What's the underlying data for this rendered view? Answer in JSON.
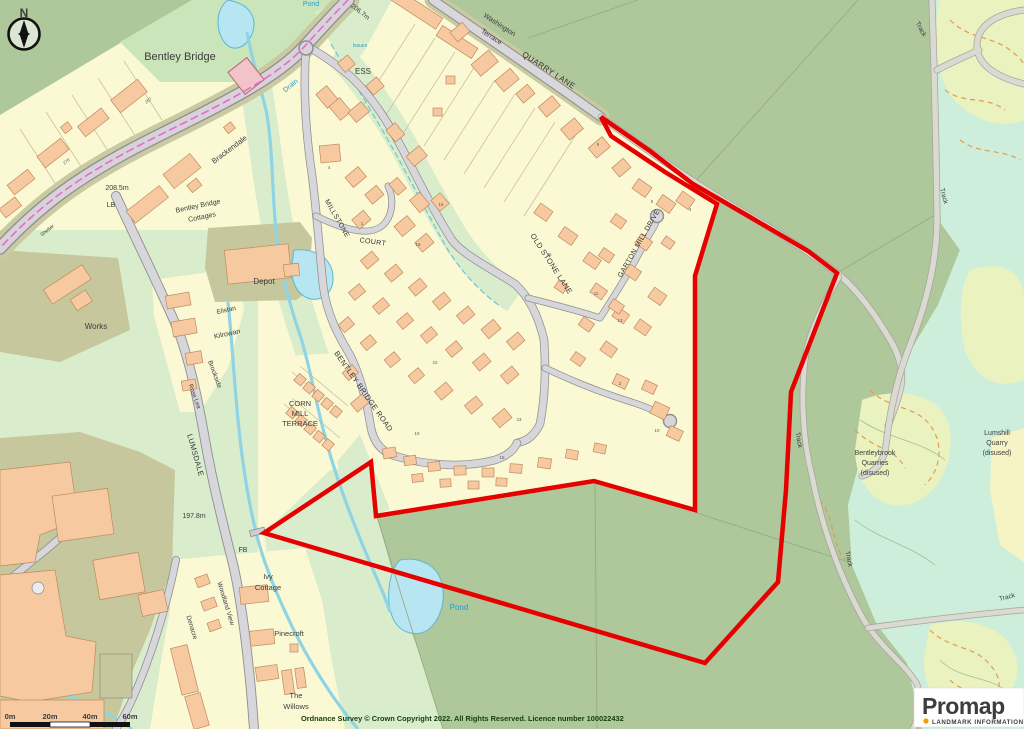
{
  "app": {
    "view": "promap-ordnance-survey-site-plan"
  },
  "logo": {
    "brand": "Promap",
    "tagline": "LANDMARK INFORMATION"
  },
  "compass": {
    "north": "N"
  },
  "scale_bar": {
    "m0": "0m",
    "m20": "20m",
    "m40": "40m",
    "m60": "60m"
  },
  "copyright": "Ordnance Survey © Crown Copyright 2022. All Rights Reserved. Licence number 100022432",
  "colors": {
    "boundary_red": "#e60000",
    "field_green": "#aec79b",
    "amenity_green": "#d9edcc",
    "quarry_mint": "#cdeeda",
    "residential_yellow": "#fbf9d4",
    "building_salmon": "#f6c9a0",
    "water_blue": "#b7e6f2",
    "road_grey": "#d7d7dc",
    "logo_orange": "#f59b00"
  },
  "labels": {
    "places": {
      "bentley_bridge": "Bentley Bridge",
      "brackendale": "Brackendale",
      "bentley_bridge_cottages_line1": "Bentley Bridge",
      "bentley_bridge_cottages_line2": "Cottages",
      "depot": "Depot",
      "works": "Works",
      "elistan": "Elistan",
      "kilrowan": "Kilrowan",
      "brookside": "Brookside",
      "rose_lea": "Rose Lea",
      "corn_mill_line1": "CORN",
      "corn_mill_line2": "MILL",
      "corn_mill_line3": "TERRACE",
      "ess": "ESS",
      "shelter": "Shelter",
      "ivy_cottage_line1": "Ivy",
      "ivy_cottage_line2": "Cottage",
      "pinecroft": "Pinecroft",
      "the_willows_line1": "The",
      "the_willows_line2": "Willows",
      "woodland_view": "Woodland View",
      "denacre": "Denacre",
      "washington_terrace_line1": "Washington",
      "washington_terrace_line2": "Terrace",
      "bentleybrook_line1": "Bentleybrook",
      "bentleybrook_line2": "Quarries",
      "bentleybrook_line3": "(disused)",
      "lumshill_line1": "Lumshill",
      "lumshill_line2": "Quarry",
      "lumshill_line3": "(disused)"
    },
    "roads": {
      "quarry_lane": "QUARRY LANE",
      "millstone_line1": "MILLSTONE",
      "millstone_line2": "COURT",
      "old_stone_lane": "OLD STONE LANE",
      "garton_mill_drive": "GARTON MILL DRIVE",
      "bentley_bridge_road": "BENTLEY BRIDGE ROAD",
      "lumsdale": "LUMSDALE",
      "track": "Track"
    },
    "water": {
      "drain": "Drain",
      "pond": "Pond",
      "issues": "Issues"
    },
    "annotations": {
      "lb": "LB",
      "fb": "FB",
      "height_206": "206.7m",
      "height_208": "208.5m",
      "height_197": "197.8m"
    },
    "plot_numbers": [
      "267",
      "279",
      "4",
      "1",
      "16",
      "18",
      "76",
      "23",
      "19",
      "22",
      "9",
      "5",
      "4",
      "11",
      "13",
      "2",
      "10",
      "15"
    ]
  }
}
